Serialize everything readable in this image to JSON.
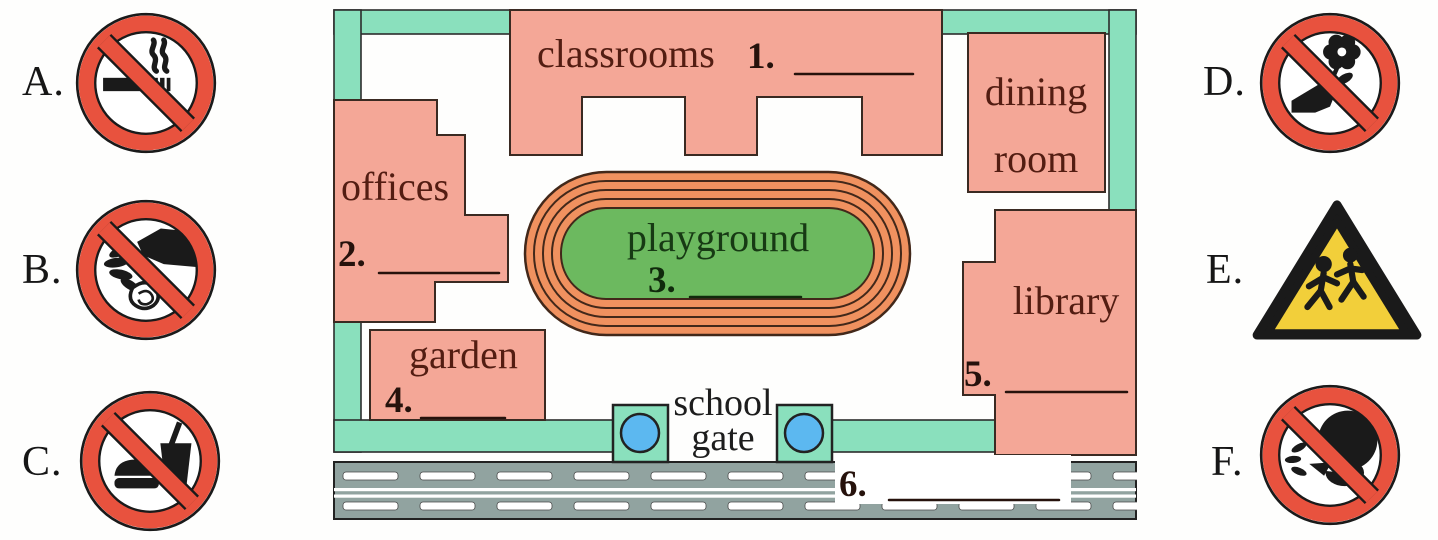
{
  "signs": {
    "A": {
      "letter": "A.",
      "icon": "no-smoking-icon"
    },
    "B": {
      "letter": "B.",
      "icon": "no-littering-icon"
    },
    "C": {
      "letter": "C.",
      "icon": "no-food-or-drink-icon"
    },
    "D": {
      "letter": "D.",
      "icon": "no-picking-flowers-icon"
    },
    "E": {
      "letter": "E.",
      "icon": "children-crossing-warning-icon"
    },
    "F": {
      "letter": "F.",
      "icon": "no-spitting-icon"
    }
  },
  "map": {
    "buildings": {
      "classrooms": "classrooms",
      "offices": "offices",
      "playground": "playground",
      "garden": "garden",
      "dining_room_line1": "dining",
      "dining_room_line2": "room",
      "library": "library",
      "school_gate_line1": "school",
      "school_gate_line2": "gate"
    },
    "blanks": {
      "b1": "1.",
      "b2": "2.",
      "b3": "3.",
      "b4": "4.",
      "b5": "5.",
      "b6": "6."
    }
  },
  "colors": {
    "prohibition_red": "#e8523e",
    "warning_yellow": "#f2cf3a",
    "building_pink": "#f4a797",
    "border_teal": "#8ae0bd",
    "track_orange": "#f0915f",
    "field_green": "#6cb95f",
    "road_gray": "#91a3a0",
    "gate_dot_blue": "#5cb8f0",
    "label_maroon": "#531d12"
  }
}
